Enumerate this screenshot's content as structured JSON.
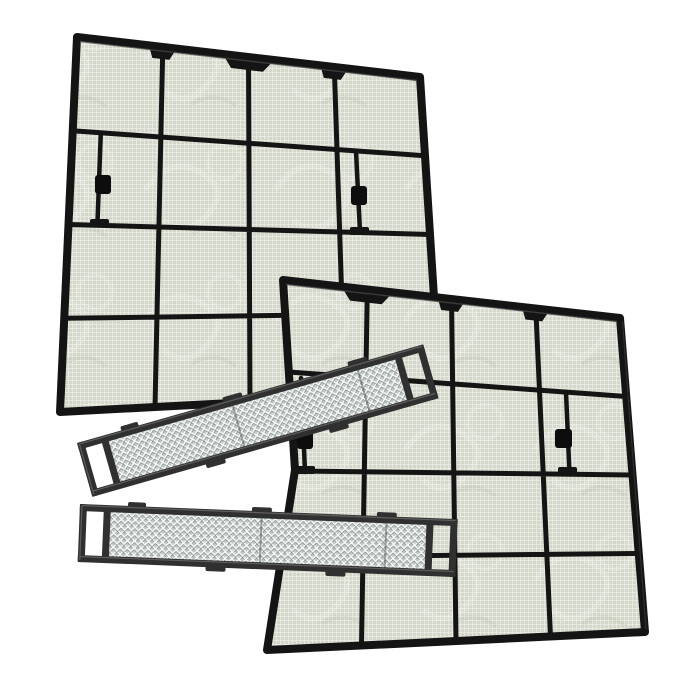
{
  "image": {
    "kind": "product-photo",
    "subject": "Air conditioner mesh filter set on white background",
    "items": [
      {
        "label": "Large mesh filter (back left)",
        "features": "black plastic frame, 4x4 mesh grid, side clip tabs, top handle tabs"
      },
      {
        "label": "Large mesh filter (front right)",
        "features": "black plastic frame, 4x4 mesh grid, side clip tabs, top handle tabs"
      },
      {
        "label": "Narrow strip filter (upper)",
        "features": "diamond lattice mesh, dark rails, ladder end caps"
      },
      {
        "label": "Narrow strip filter (lower)",
        "features": "diamond lattice mesh, dark rails, ladder end caps"
      }
    ]
  },
  "colors": {
    "background": "#ffffff",
    "frame": "#141414",
    "frame_highlight": "#4a4a4a",
    "mesh_base": "#d3d7c9",
    "mesh_line": "#ffffff",
    "mesh_sheen": "#ffffff",
    "mesh_shade": "#8a9478",
    "clip": "#0d0d0d",
    "strip_frame": "#303030",
    "strip_frame_highlight": "#6a6a6a",
    "strip_mesh_base": "#c2cbc8",
    "strip_lattice": "#f7faf8",
    "strip_lattice_shadow": "#434846"
  }
}
